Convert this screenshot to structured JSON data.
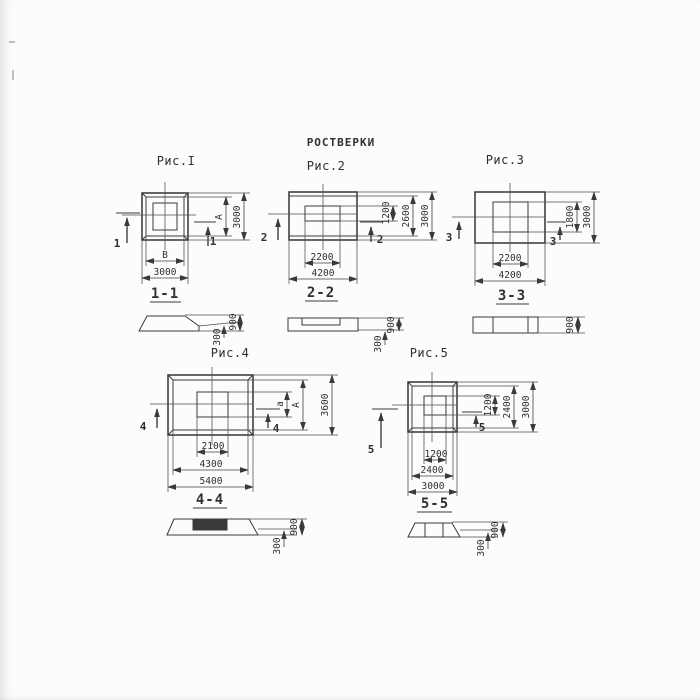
{
  "title": "РОСТВЕРКИ",
  "colors": {
    "ink": "#3a3a3a",
    "paper": "#fcfcfb"
  },
  "figures": {
    "fig1": {
      "label": "Рис.I",
      "cut_label": "1",
      "section_label": "1-1",
      "dims": {
        "inner_width": "В",
        "outer_width": "3000",
        "inner_height": "А",
        "outer_height": "3000"
      },
      "section_dims": {
        "ledge": "300",
        "total": "900"
      }
    },
    "fig2": {
      "label": "Рис.2",
      "cut_label": "2",
      "section_label": "2-2",
      "dims": {
        "inner_width": "2200",
        "outer_width": "4200",
        "inner_height": "1200",
        "mid_height": "2600",
        "outer_height": "3000"
      },
      "section_dims": {
        "ledge": "300",
        "total": "900"
      }
    },
    "fig3": {
      "label": "Рис.3",
      "cut_label": "3",
      "section_label": "3-3",
      "dims": {
        "inner_width": "2200",
        "outer_width": "4200",
        "inner_height": "1800",
        "outer_height": "3000"
      },
      "section_dims": {
        "total": "900"
      }
    },
    "fig4": {
      "label": "Рис.4",
      "cut_label": "4",
      "section_label": "4-4",
      "dims": {
        "inner_width": "2100",
        "mid_width": "4300",
        "outer_width": "5400",
        "inner_height": "а",
        "mid_height": "А",
        "outer_height": "3600"
      },
      "section_dims": {
        "ledge": "300",
        "total": "900"
      }
    },
    "fig5": {
      "label": "Рис.5",
      "cut_label": "5",
      "section_label": "5-5",
      "dims": {
        "inner_width": "1200",
        "mid_width": "2400",
        "outer_width": "3000",
        "inner_height": "1200",
        "mid_height": "2400",
        "outer_height": "3000"
      },
      "section_dims": {
        "ledge": "300",
        "total": "900"
      }
    }
  }
}
